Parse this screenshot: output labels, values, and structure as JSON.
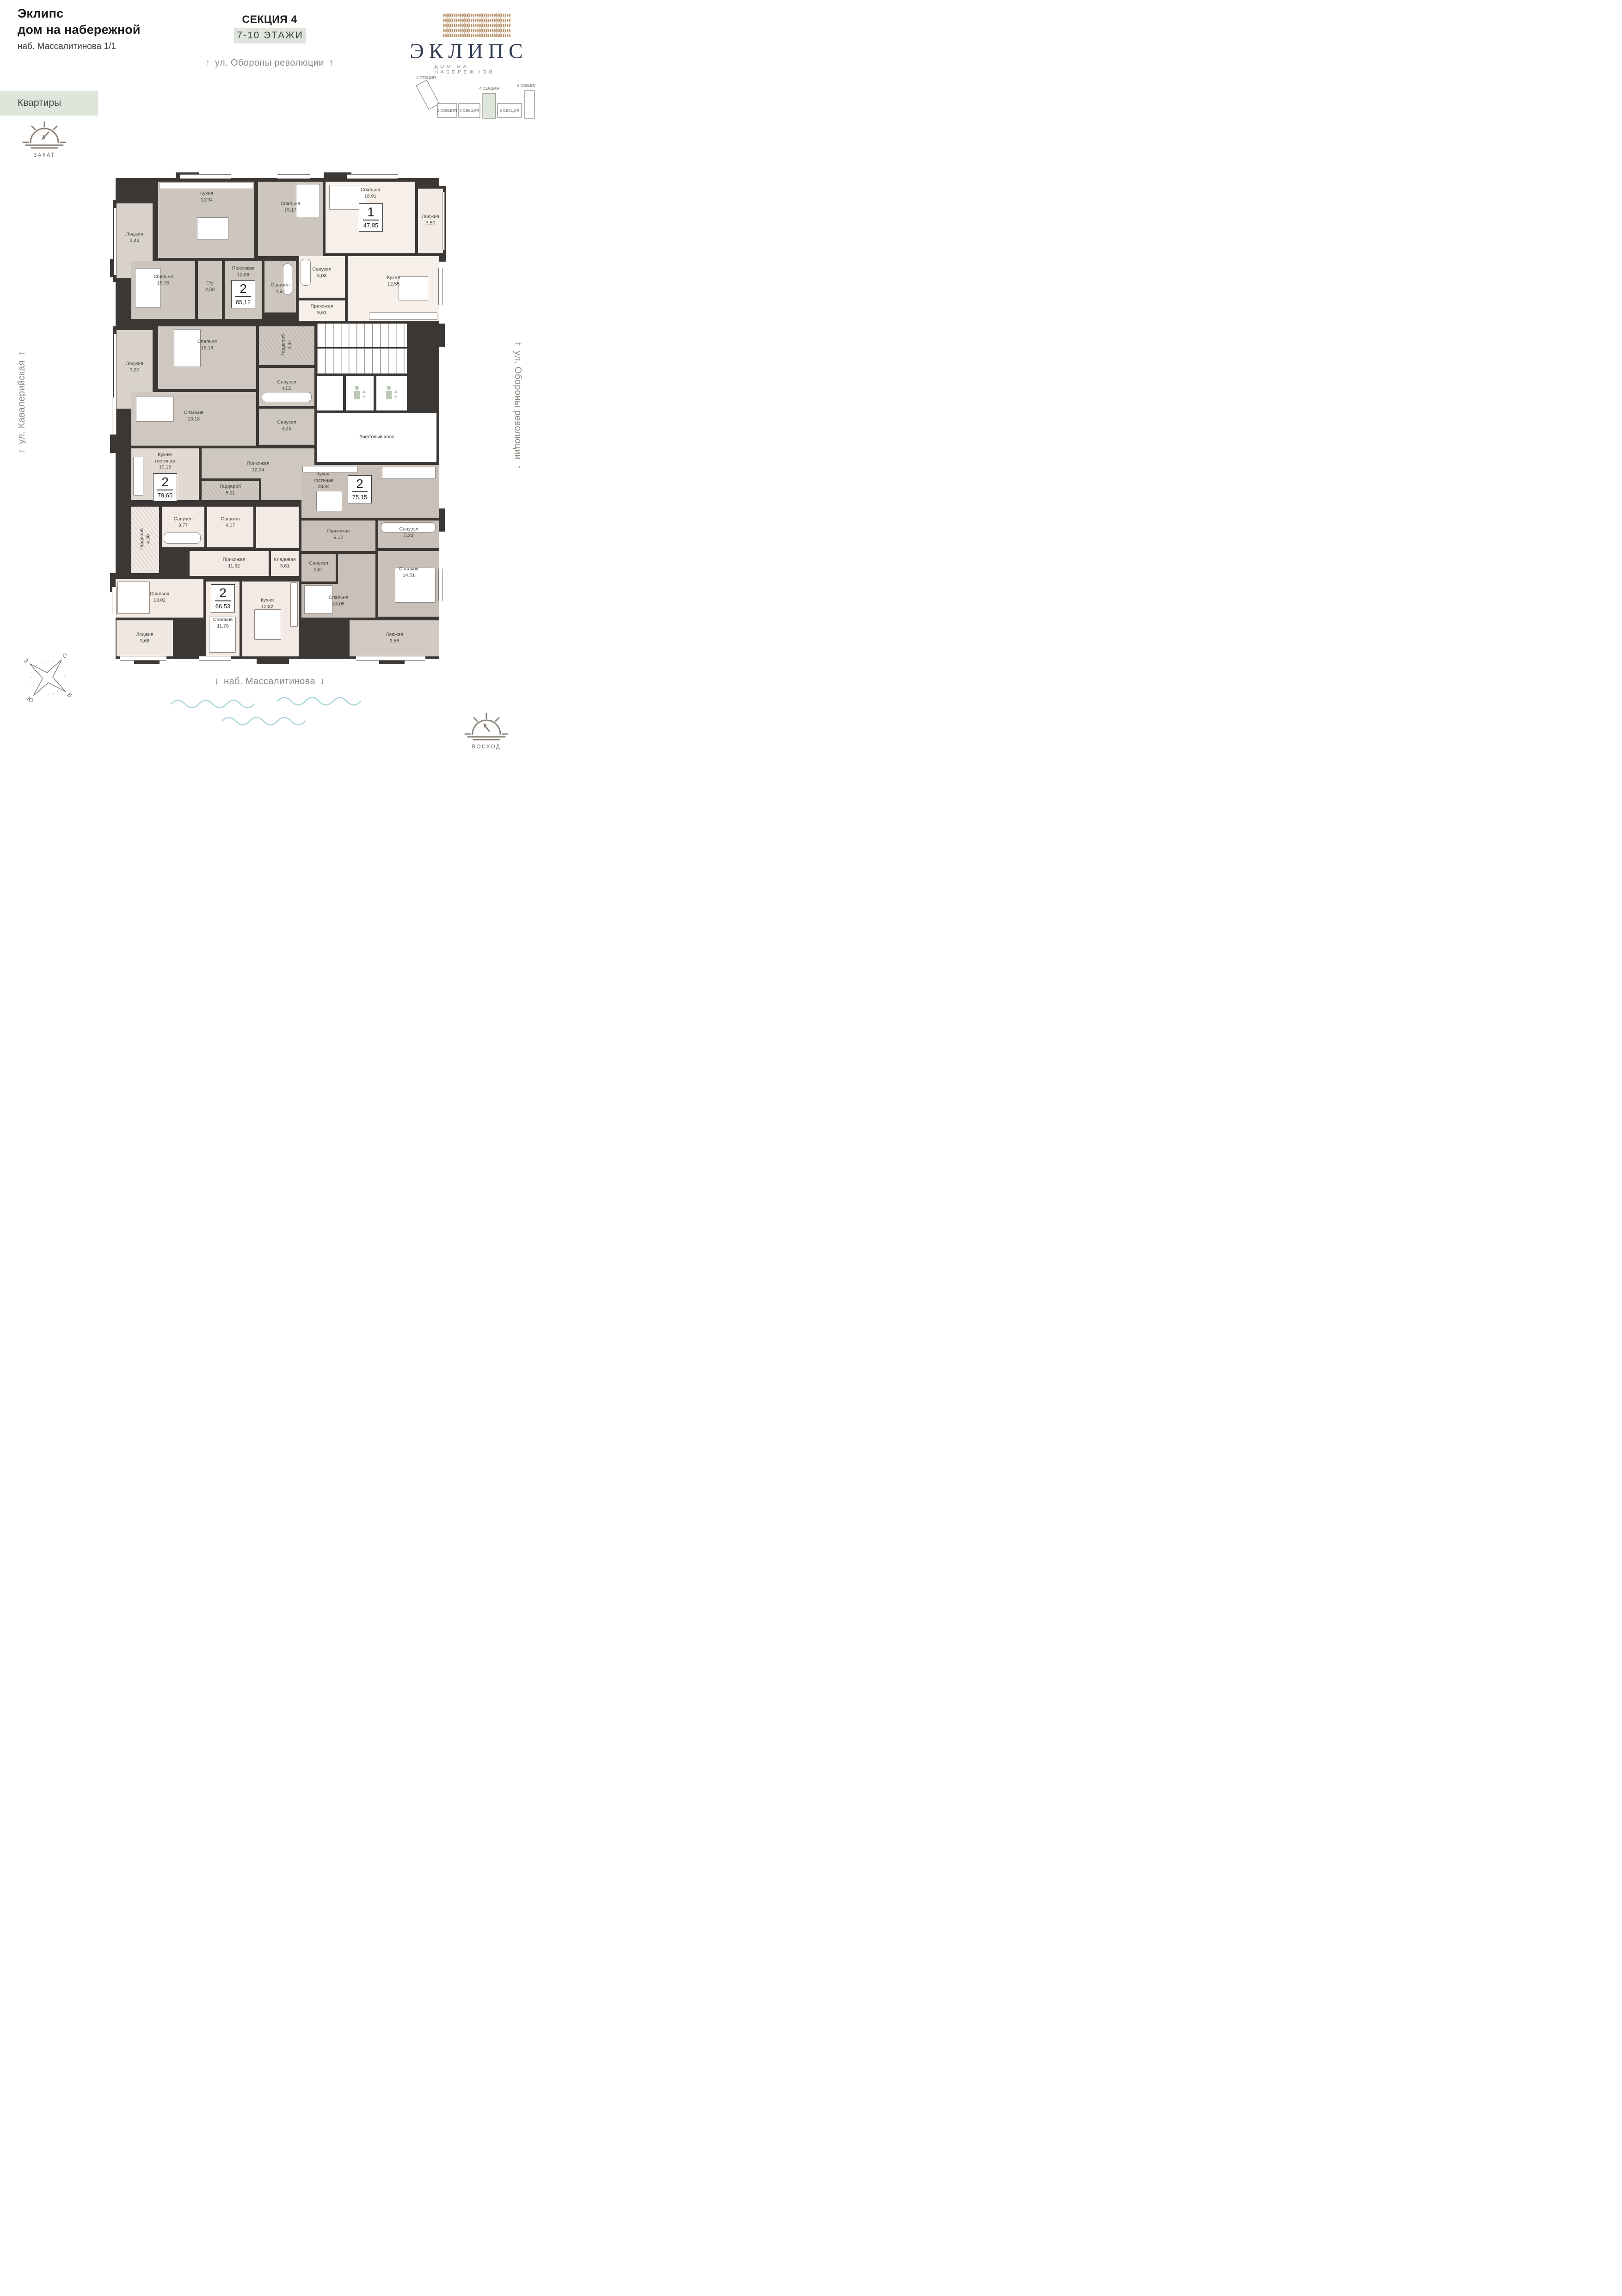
{
  "header": {
    "project_title_line1": "Эклипс",
    "project_title_line2": "дом на набережной",
    "address": "наб. Массалитинова 1/1",
    "apartments_tag": "Квартиры",
    "section_title": "СЕКЦИЯ 4",
    "floors_badge": "7-10 ЭТАЖИ"
  },
  "logo": {
    "brand": "ЭКЛИПС",
    "subtitle": "ДОМ НА НАБЕРЕЖНОЙ"
  },
  "site_plan": {
    "sections": [
      "1 СЕКЦИЯ",
      "2 СЕКЦИЯ",
      "3 СЕКЦИЯ",
      "4 СЕКЦИЯ",
      "5 СЕКЦИЯ",
      "6 СЕКЦИЯ"
    ],
    "highlighted_section": "4 СЕКЦИЯ"
  },
  "streets": {
    "top": "ул. Обороны революции",
    "left": "ул. Кавалерийская",
    "right": "ул. Обороны революции",
    "embankment": "наб. Массалитинова"
  },
  "icons": {
    "up_arrow": "↑",
    "down_arrow": "↓"
  },
  "sun_icons": {
    "sunset": "ЗАКАТ",
    "sunrise": "ВОСХОД"
  },
  "compass": {
    "n": "С",
    "s": "Ю",
    "w": "З",
    "e": "В"
  },
  "core": {
    "elevator_hall": "Лифтовый холл"
  },
  "apartments": [
    {
      "id": "apt-65-12",
      "rooms_count": "2",
      "total_area": "65,12",
      "rooms": [
        {
          "name": "Кухня",
          "area": "12,94"
        },
        {
          "name": "Лоджия",
          "area": "3,46"
        },
        {
          "name": "Спальня",
          "area": "15,17"
        },
        {
          "name": "Спальня",
          "area": "15,78"
        },
        {
          "name": "С/у",
          "area": "2,50"
        },
        {
          "name": "Прихожая",
          "area": "12,06"
        },
        {
          "name": "Санузел",
          "area": "4,94"
        }
      ]
    },
    {
      "id": "apt-47-85",
      "rooms_count": "1",
      "total_area": "47,85",
      "rooms": [
        {
          "name": "Спальня",
          "area": "18,91"
        },
        {
          "name": "Лоджия",
          "area": "3,50"
        },
        {
          "name": "Санузел",
          "area": "5,03"
        },
        {
          "name": "Кухня",
          "area": "12,55"
        },
        {
          "name": "Прихожая",
          "area": "9,61"
        }
      ]
    },
    {
      "id": "apt-79-65",
      "rooms_count": "2",
      "total_area": "79,65",
      "rooms": [
        {
          "name": "Спальня",
          "area": "15,18"
        },
        {
          "name": "Лоджия",
          "area": "3,30"
        },
        {
          "name": "Гардероб",
          "area": "4,34"
        },
        {
          "name": "Санузел",
          "area": "4,55"
        },
        {
          "name": "Спальня",
          "area": "13,18"
        },
        {
          "name": "Санузел",
          "area": "4,45"
        },
        {
          "name": "Кухня-гостиная",
          "area": "19,15"
        },
        {
          "name": "Прихожая",
          "area": "12,04"
        },
        {
          "name": "Гардероб",
          "area": "5,11"
        }
      ]
    },
    {
      "id": "apt-75-15",
      "rooms_count": "2",
      "total_area": "75,15",
      "rooms": [
        {
          "name": "Кухня-гостиная",
          "area": "28,84"
        },
        {
          "name": "Прихожая",
          "area": "9,12"
        },
        {
          "name": "Санузел",
          "area": "5,23"
        },
        {
          "name": "Санузел",
          "area": "2,61"
        },
        {
          "name": "Спальня",
          "area": "14,51"
        },
        {
          "name": "Спальня",
          "area": "13,05"
        },
        {
          "name": "Лоджия",
          "area": "3,58"
        }
      ]
    },
    {
      "id": "apt-66-53",
      "rooms_count": "2",
      "total_area": "66,53",
      "rooms": [
        {
          "name": "Гардероб",
          "area": "4,30"
        },
        {
          "name": "Санузел",
          "area": "3,77"
        },
        {
          "name": "Санузел",
          "area": "4,07"
        },
        {
          "name": "Прихожая",
          "area": "11,32"
        },
        {
          "name": "Кладовая",
          "area": "3,61"
        },
        {
          "name": "Спальня",
          "area": "13,02"
        },
        {
          "name": "Спальня",
          "area": "11,78"
        },
        {
          "name": "Кухня",
          "area": "12,82"
        },
        {
          "name": "Лоджия",
          "area": "3,68"
        }
      ]
    }
  ],
  "colors": {
    "accent_green": "#dee6db",
    "wall": "#3b3734",
    "logo_navy": "#2d3950",
    "pattern_tan": "#b8926a",
    "water_blue": "#a9d6da",
    "room_greige": "#cdc6bf",
    "room_light": "#f3eae5"
  }
}
